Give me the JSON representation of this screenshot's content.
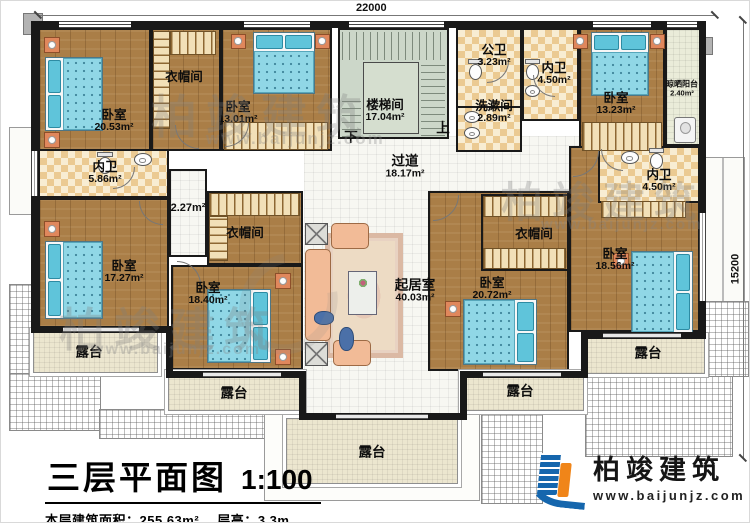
{
  "dimensions": {
    "top": "22000",
    "right": "15200"
  },
  "rooms": {
    "bedroom_tl": {
      "name": "卧室",
      "area": "20.53m²"
    },
    "cloakroom_top": {
      "name": "衣帽间"
    },
    "bedroom_tc": {
      "name": "卧室",
      "area": "13.01m²"
    },
    "stairwell": {
      "name": "楼梯间",
      "area": "17.04m²"
    },
    "public_bath": {
      "name": "公卫",
      "area": "3.23m²"
    },
    "ensuite_top": {
      "name": "内卫",
      "area": "4.50m²"
    },
    "washroom": {
      "name": "洗漱间",
      "area": "2.89m²"
    },
    "bedroom_tr": {
      "name": "卧室",
      "area": "13.23m²"
    },
    "drying_balcony": {
      "name": "晾晒阳台",
      "area": "2.40m²"
    },
    "ensuite_left": {
      "name": "内卫",
      "area": "5.86m²"
    },
    "bedroom_ml": {
      "name": "卧室",
      "area": "17.27m²"
    },
    "small_area": {
      "area": "2.27m²"
    },
    "cloakroom_center": {
      "name": "衣帽间"
    },
    "bedroom_cb": {
      "name": "卧室",
      "area": "18.40m²"
    },
    "corridor": {
      "name": "过道",
      "area": "18.17m²"
    },
    "living_room": {
      "name": "起居室",
      "area": "40.03m²"
    },
    "ensuite_right": {
      "name": "内卫",
      "area": "4.50m²"
    },
    "cloakroom_right": {
      "name": "衣帽间"
    },
    "bedroom_rc": {
      "name": "卧室",
      "area": "20.72m²"
    },
    "bedroom_right": {
      "name": "卧室",
      "area": "18.56m²"
    },
    "terrace": {
      "name": "露台"
    }
  },
  "stairs": {
    "up": "上",
    "down": "下"
  },
  "title_block": {
    "title": "三层平面图",
    "scale": "1:100",
    "area_label": "本层建筑面积：",
    "area_value": "255.63m²",
    "height_label": "层高：",
    "height_value": "3.3m"
  },
  "logo": {
    "name": "柏竣建筑",
    "url": "www.baijunjz.com"
  },
  "watermark": {
    "text": "柏竣建筑",
    "url": "www.baijunjz.com"
  },
  "colors": {
    "wall": "#161616",
    "wood_floor": "#aa7e47",
    "tile_checker": "#ebca92",
    "stair_floor": "#ccd7c9",
    "terrace_floor": "#ece6cf",
    "bed_blue": "#90d7e6",
    "furniture_orange": "#e0875c",
    "sofa_salmon": "#f2bb97",
    "logo_blue": "#1566ad",
    "logo_orange": "#f08519"
  }
}
